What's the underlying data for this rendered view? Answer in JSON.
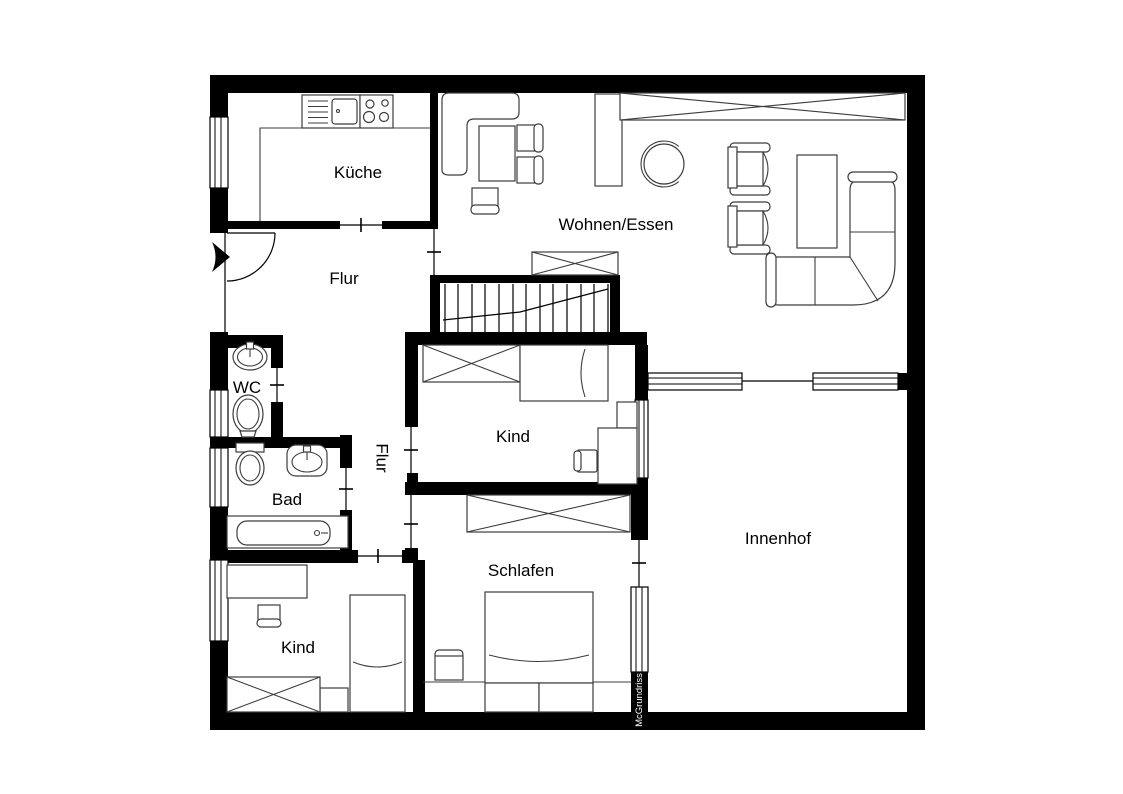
{
  "rooms": {
    "kueche": "Küche",
    "wohnen_essen": "Wohnen/Essen",
    "flur": "Flur",
    "flur2": "Flur",
    "wc": "WC",
    "bad": "Bad",
    "kind_top": "Kind",
    "schlafen": "Schlafen",
    "kind_bottom": "Kind",
    "innenhof": "Innenhof"
  },
  "watermark": "McGrundriss",
  "colors": {
    "wall": "#000000",
    "furniture_outline": "#3c3c3c",
    "background": "#ffffff",
    "watermark_bar": "#000000",
    "watermark_text": "#ffffff"
  }
}
